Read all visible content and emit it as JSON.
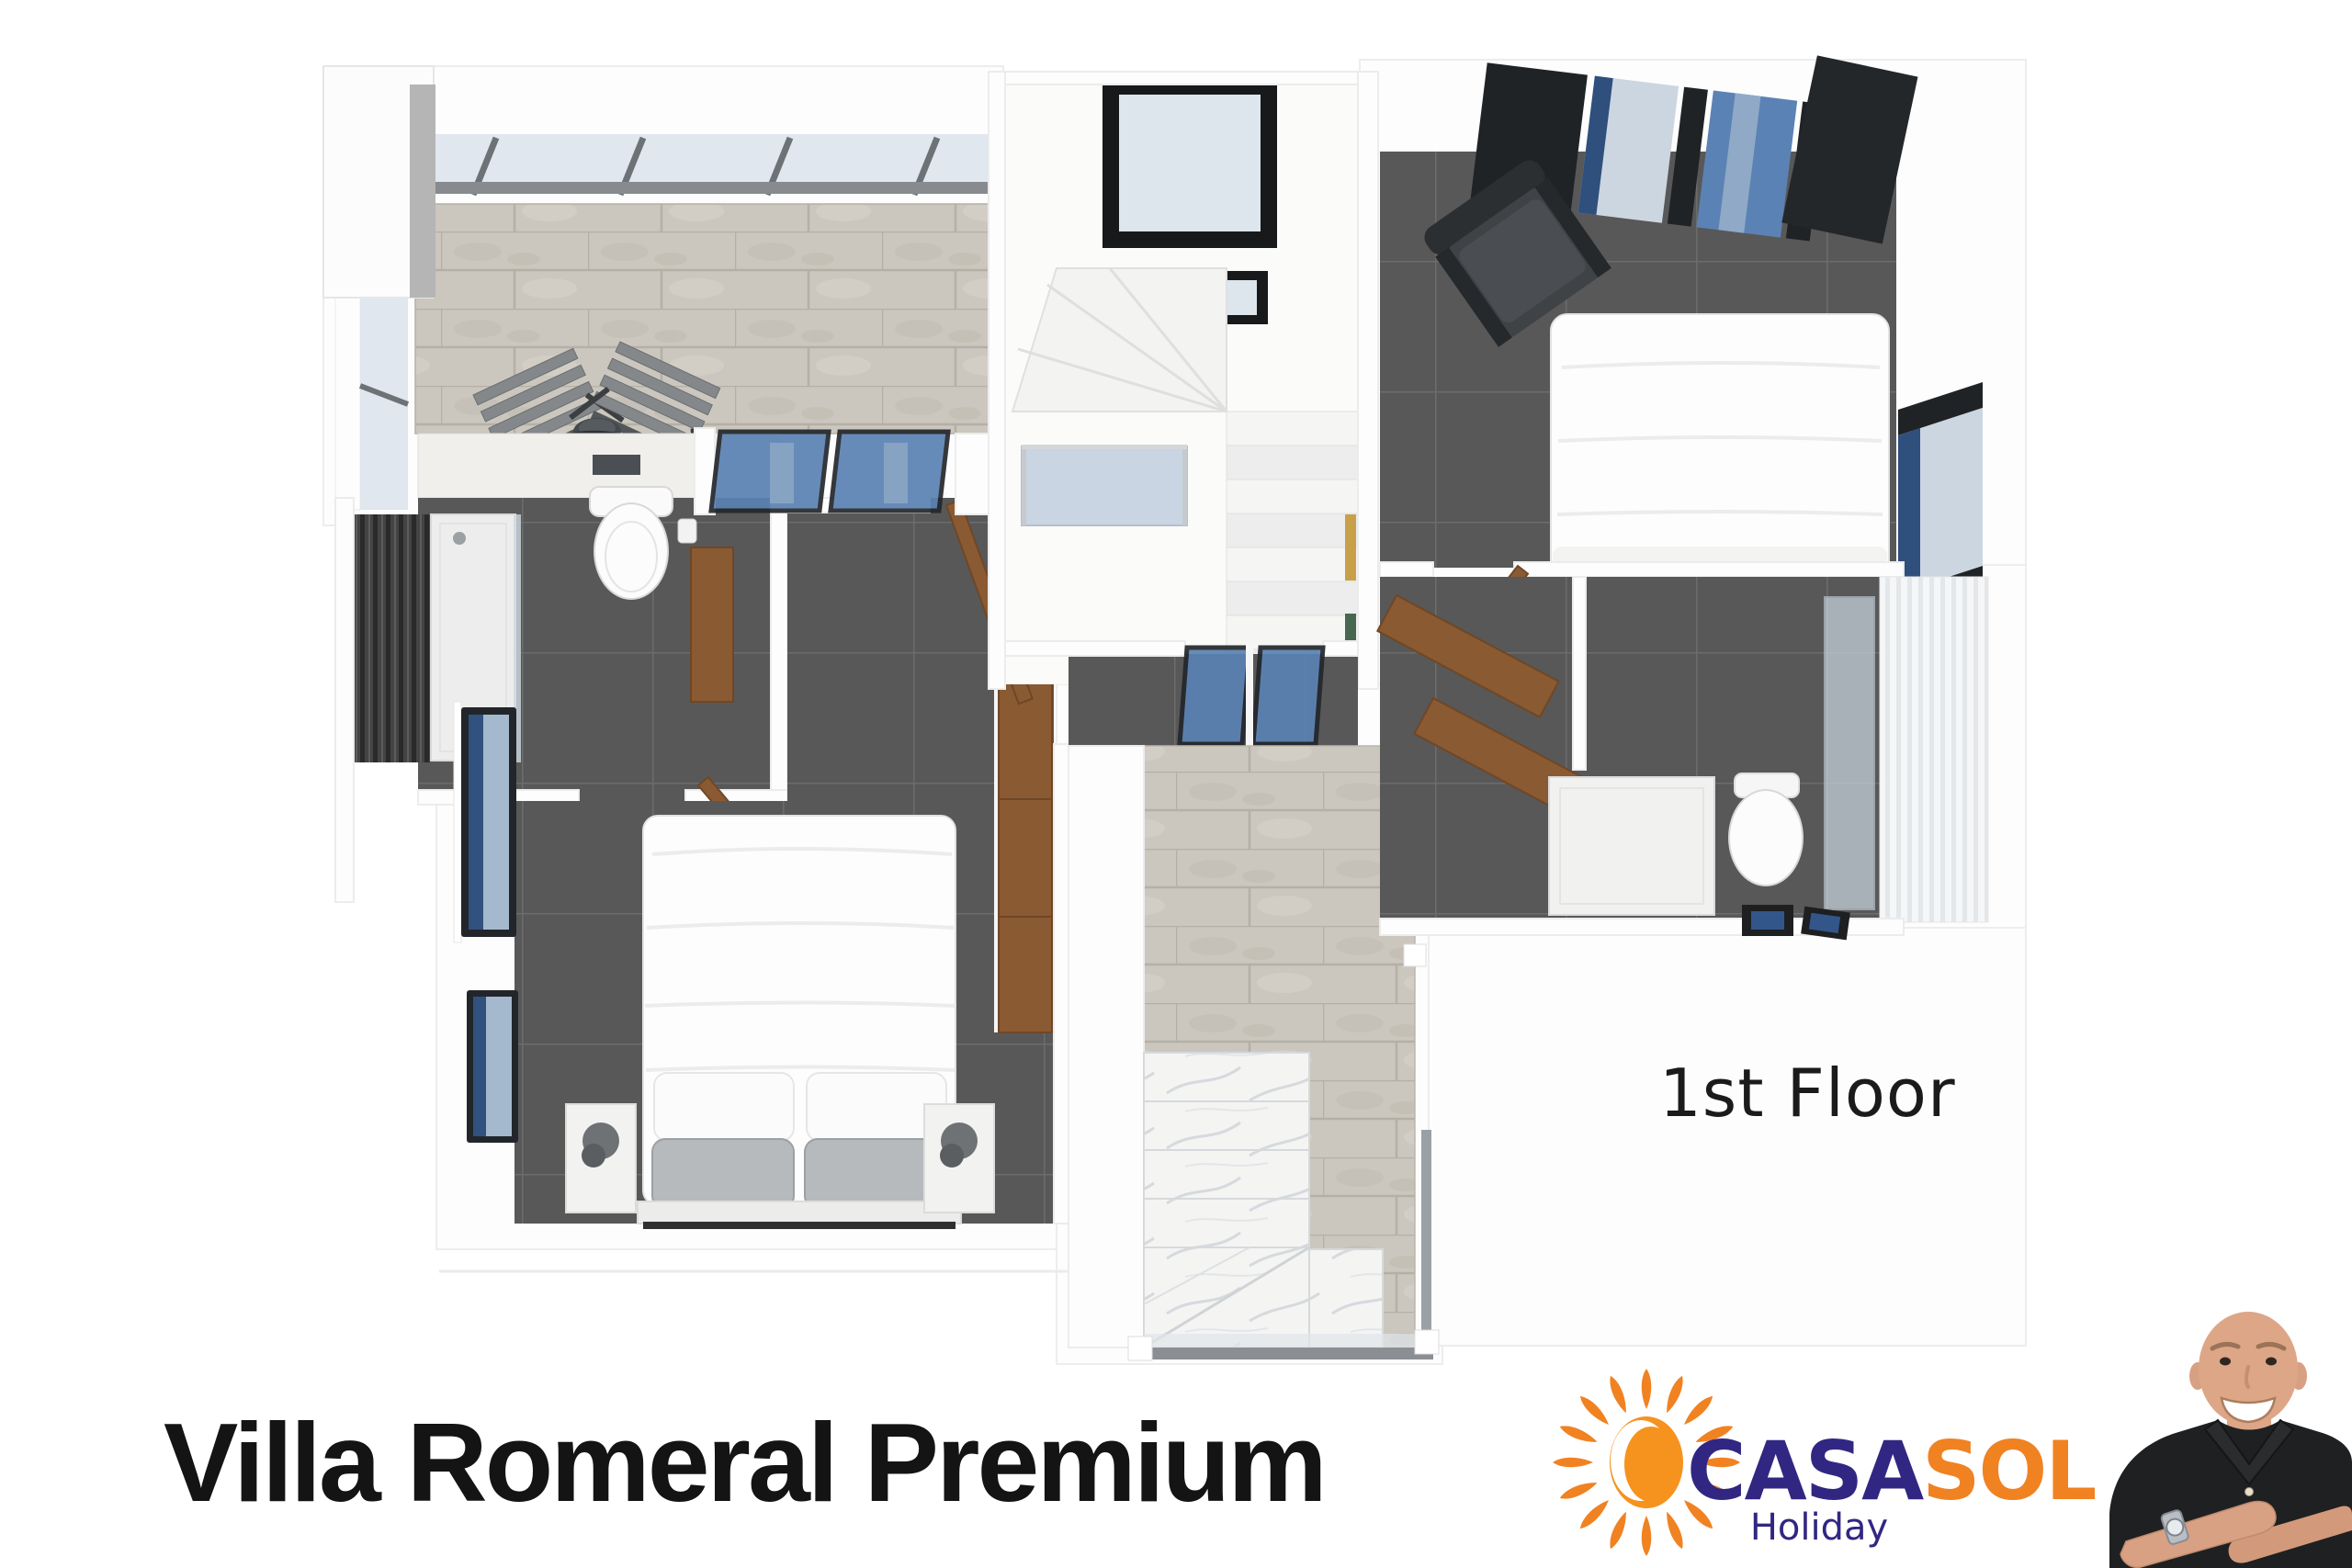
{
  "plan": {
    "floor_label": "1st Floor"
  },
  "footer": {
    "title": "Villa Romeral Premium"
  },
  "logo": {
    "part1": "CASA",
    "part2": "SOL",
    "subtitle": "Holiday"
  },
  "palette": {
    "navy": "#312782",
    "orange": "#f08222",
    "sun": "#f6921e",
    "wood": "#8a5a33",
    "glass": "#5b82b4",
    "floor_dark": "#585858",
    "stone": "#cbc7be",
    "skin": "#dca687",
    "shirt": "#1f2022"
  }
}
